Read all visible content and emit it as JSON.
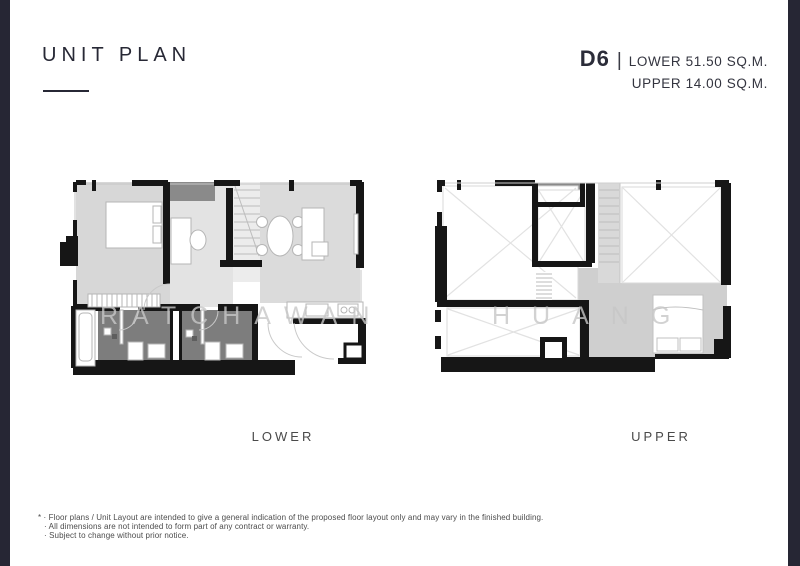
{
  "header": {
    "title": "UNIT PLAN",
    "unit_code": "D6",
    "separator": "|",
    "lower_area": "LOWER 51.50 SQ.M.",
    "upper_area": "UPPER  14.00 SQ.M."
  },
  "plans": {
    "lower": {
      "label": "LOWER"
    },
    "upper": {
      "label": "UPPER"
    }
  },
  "watermark": {
    "word1": "RATCHAWAN",
    "word2": "HUANG"
  },
  "footnotes": [
    "* · Floor plans / Unit Layout are intended to give a general indication of the proposed floor layout only and may vary in the finished building.",
    "· All dimensions are not intended to form part of any contract or warranty.",
    "· Subject to change without prior notice."
  ],
  "colors": {
    "edge_bar": "#262634",
    "wall": "#161616",
    "floor_light": "#d7d7d7",
    "floor_mid": "#e3e3e3",
    "floor_living": "#dbdbdb",
    "floor_bath_dark": "#7d7d7d",
    "floor_loft": "#cfcfcf",
    "ac_ledge": "#8a8a8a",
    "text_primary": "#2b2c39",
    "watermark": "#c7c7c7"
  }
}
